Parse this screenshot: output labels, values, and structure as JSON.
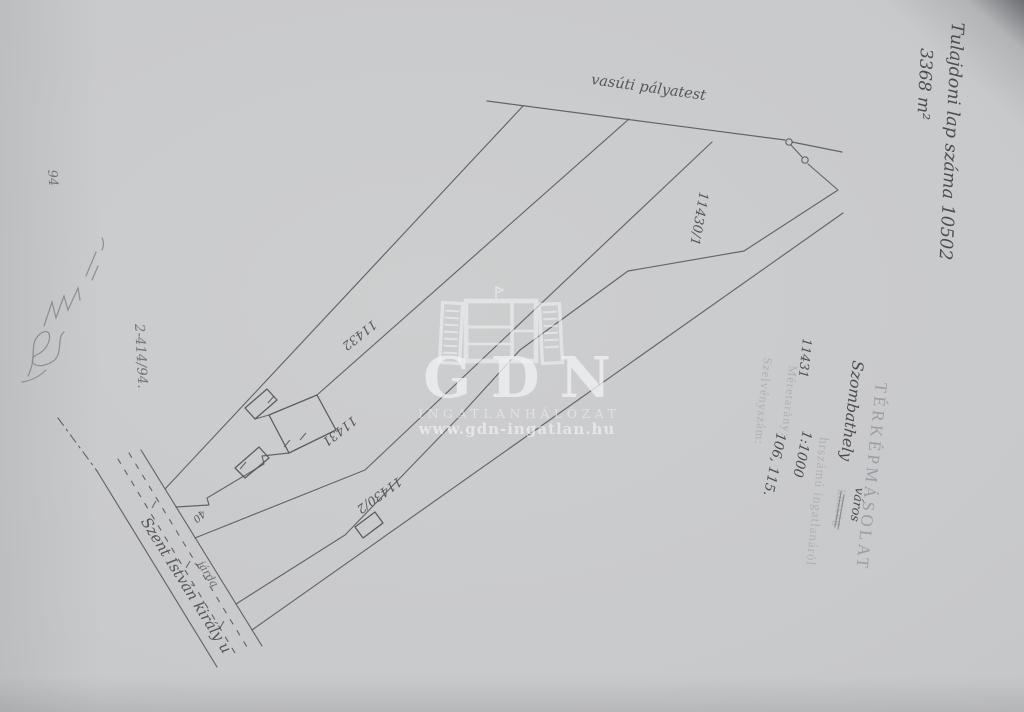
{
  "annotations": {
    "owner_sheet": "Tulajdoni lap száma 10502",
    "area": "3368 m²",
    "corner_number": "94",
    "file_number": "2-414/94."
  },
  "stamp": {
    "title": "TÉRKÉPMÁSOLAT",
    "settlement": "Szombathely",
    "settlement_type_new": "város",
    "settlement_type_old": "község",
    "parcel_number": "11431",
    "parcel_suffix": "hrszámú ingatlanáról",
    "scale_label": "Méretarány:",
    "scale_value": "1:1000",
    "sheet_label": "Szelvényszám:",
    "sheet_value": "106, 115."
  },
  "map": {
    "railway_label": "vasúti pályatest",
    "street_label": "Szent István király u",
    "sidewalk_label": "járda",
    "house_number": "40",
    "parcels": {
      "p1": "11430/1",
      "p2": "11432",
      "p3": "11431",
      "p4": "11430/2"
    }
  },
  "watermark": {
    "logo_text": "GDN",
    "network_text": "INGATLANHÁLÓZAT",
    "website": "www.gdn-ingatlan.hu"
  },
  "colors": {
    "paper": "#c9cacc",
    "ink": "#5b5c61",
    "pencil": "#74757b",
    "stamp": "#9fa1a9",
    "watermark": "#eceef0"
  }
}
